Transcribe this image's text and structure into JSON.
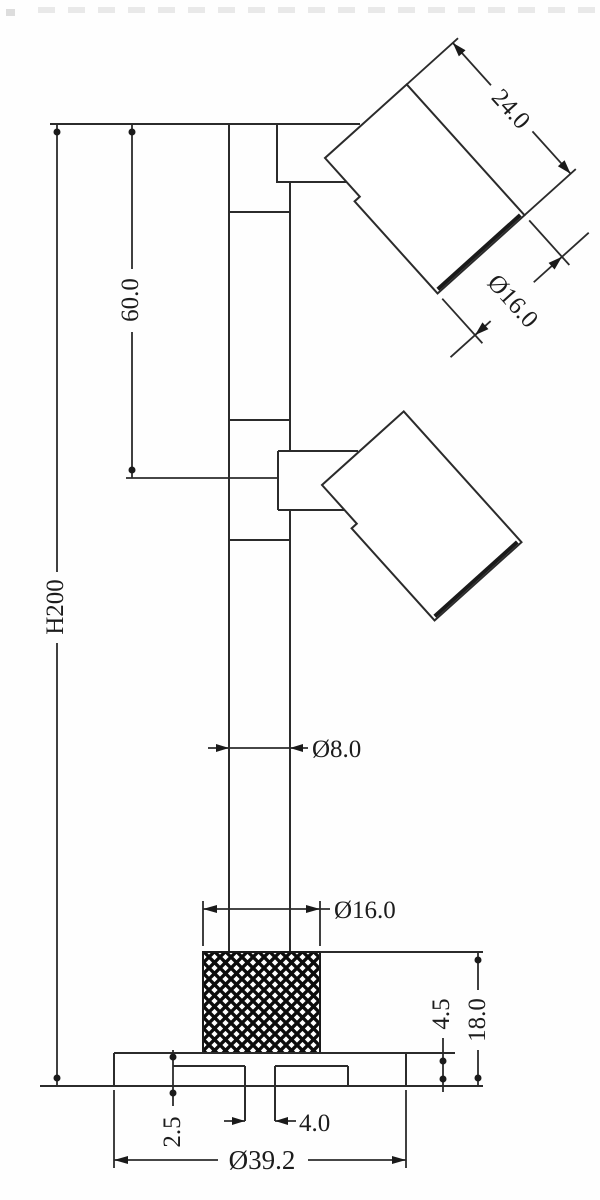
{
  "drawing": {
    "type": "technical-dimension-drawing",
    "subject": "double-head garden spotlight on pole, side elevation",
    "units_note": "",
    "dimensions": {
      "total_height": "H200",
      "head_spacing": "60.0",
      "head_length": "24.0",
      "head_lens_diameter": "Ø16.0",
      "pole_diameter": "Ø8.0",
      "knurl_diameter": "Ø16.0",
      "base_total_height": "18.0",
      "base_plate_thickness": "4.5",
      "recess_depth": "2.5",
      "center_hole_diameter": "4.0",
      "base_plate_diameter": "Ø39.2"
    },
    "colors": {
      "line": "#2b2b2b",
      "text": "#1c1c1c",
      "knurl_fill": "#0d0d0d",
      "background": "#fefefe"
    }
  }
}
